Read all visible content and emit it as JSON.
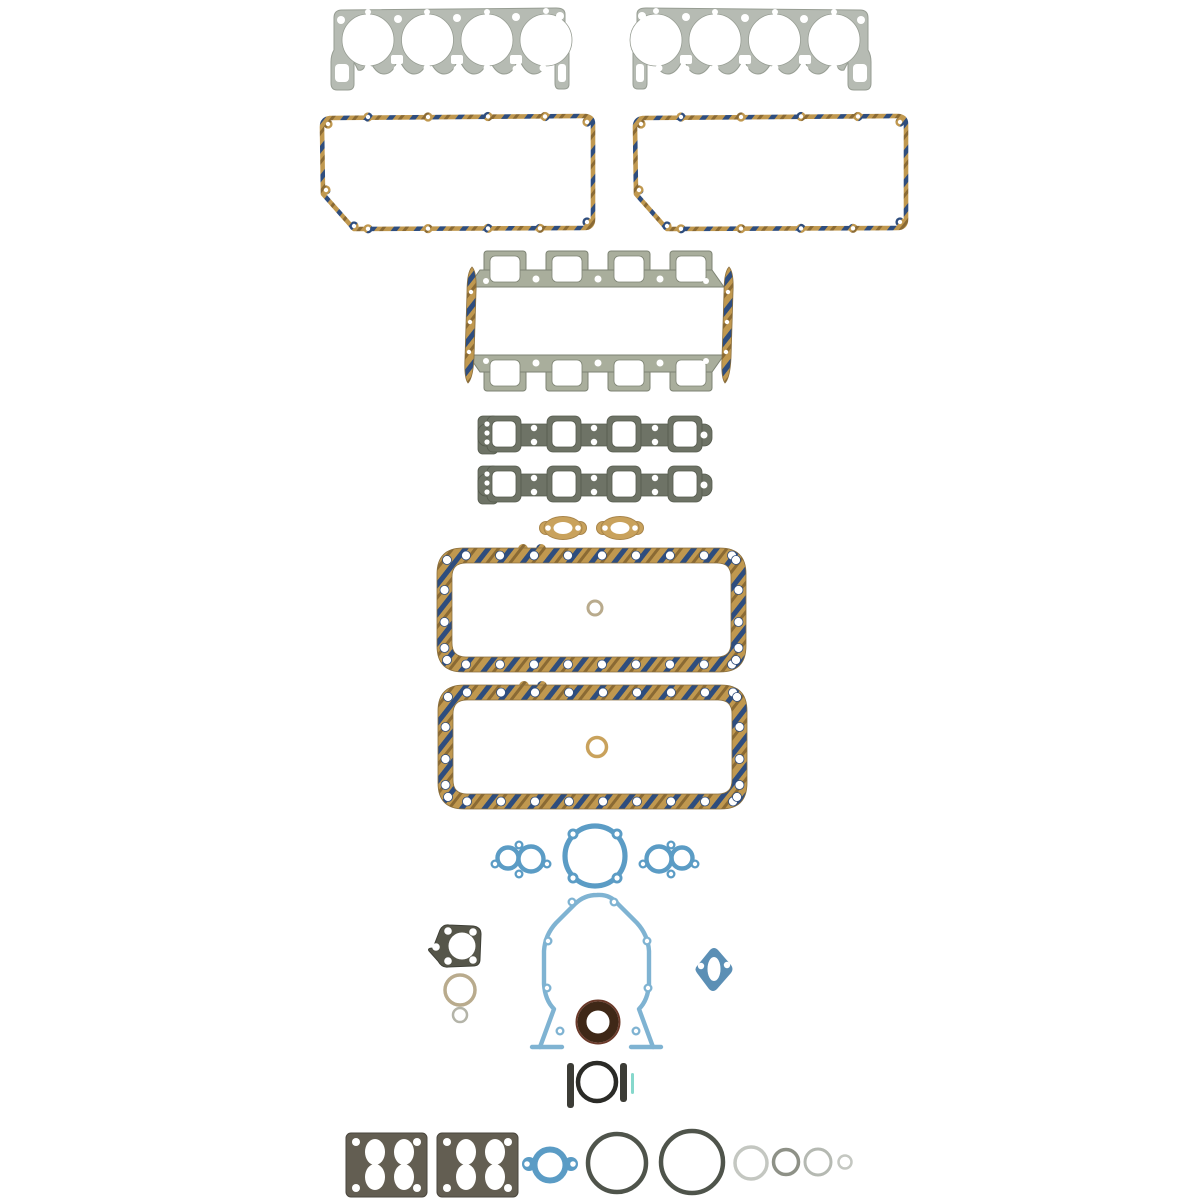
{
  "product": {
    "label": "Full engine gasket set product photo, parts laid out on white background",
    "background": "#ffffff"
  },
  "colors": {
    "bg": "#ffffff",
    "steel": "#b6bbb3",
    "steelEdge": "#979d93",
    "sage": "#a9ae9c",
    "sageDark": "#7d8373",
    "sageDark2": "#6e7366",
    "sageEdge": "#565b4e",
    "cork": "#c0984f",
    "corkNavy": "#2e4d7e",
    "corkBrown": "#8a6a34",
    "corkEdge": "#8a6f3e",
    "tan": "#c9a25c",
    "tanEdge": "#a8854b",
    "blue": "#5b9cc5",
    "blueLight": "#7fb3d2",
    "blueFill": "#5b8fb5",
    "plateDark": "#56564a",
    "plateEdge": "#3f4037",
    "oliveDark": "#635e52",
    "oliveEdge": "#4a463d",
    "ringTan": "#b9ab8d",
    "sealDark": "#3f2817",
    "sealRim": "#6b3a2a",
    "darkBar": "#3c3c36",
    "darkRing": "#2b2b27",
    "oringDark": "#4f544b",
    "grayLight": "#c4c7c1",
    "grayMid": "#8e9187",
    "teal": "#86d8cc"
  },
  "items": [
    {
      "name": "cylinder-head-gasket",
      "qty": 2
    },
    {
      "name": "valve-cover-gasket",
      "qty": 2
    },
    {
      "name": "intake-manifold-flange-gasket",
      "qty": 2
    },
    {
      "name": "intake-manifold-end-seal",
      "qty": 2
    },
    {
      "name": "exhaust-manifold-gasket",
      "qty": 2
    },
    {
      "name": "water-outlet-gasket",
      "qty": 2
    },
    {
      "name": "oil-pan-gasket",
      "qty": 2
    },
    {
      "name": "oil-pan-center-o-ring",
      "qty": 2
    },
    {
      "name": "water-pump-port-gasket",
      "qty": 2
    },
    {
      "name": "water-pump-backing-plate-gasket",
      "qty": 1
    },
    {
      "name": "timing-cover-gasket",
      "qty": 1
    },
    {
      "name": "crankshaft-front-seal",
      "qty": 1
    },
    {
      "name": "thermostat-plate-gasket",
      "qty": 1
    },
    {
      "name": "small-sealing-ring",
      "qty": 2
    },
    {
      "name": "fuel-pump-gasket",
      "qty": 1
    },
    {
      "name": "rear-main-seal-set",
      "qty": 1
    },
    {
      "name": "carburetor-base-gasket",
      "qty": 2
    },
    {
      "name": "thermostat-housing-gasket",
      "qty": 1
    },
    {
      "name": "o-ring-assortment",
      "qty": 6
    }
  ]
}
